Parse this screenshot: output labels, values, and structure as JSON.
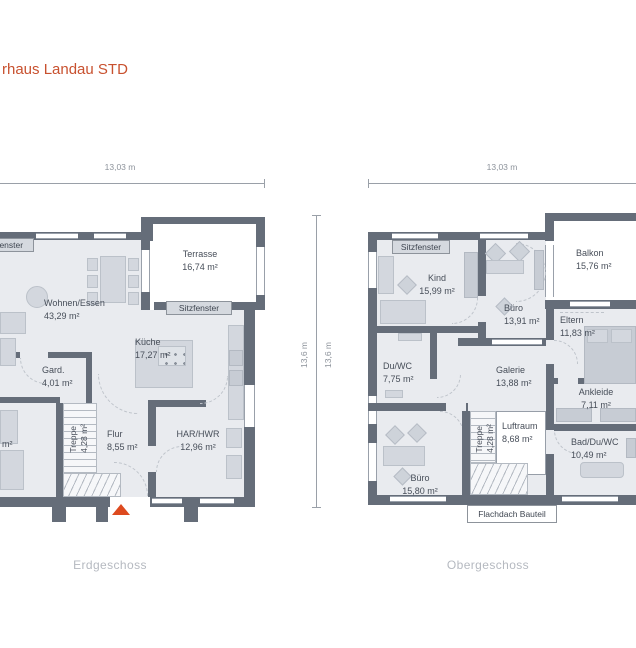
{
  "title": "rhaus Landau STD",
  "captions": {
    "left": "Erdgeschoss",
    "right": "Obergeschoss"
  },
  "dims": {
    "eg_w": "13,03 m",
    "eg_h": "13,6 m",
    "og_w": "13,03 m",
    "og_h": "13,6 m"
  },
  "eg": {
    "sitzfenster_left": "Sitzfenster",
    "sitzfenster_terrace": "Sitzfenster",
    "cut_label": "m²",
    "rooms": {
      "terrasse": {
        "label": "Terrasse",
        "area": "16,74 m²"
      },
      "wohnen": {
        "label": "Wohnen/Essen",
        "area": "43,29 m²"
      },
      "kueche": {
        "label": "Küche",
        "area": "17,27 m²"
      },
      "gard": {
        "label": "Gard.",
        "area": "4,01 m²"
      },
      "flur": {
        "label": "Flur",
        "area": "8,55 m²"
      },
      "har": {
        "label": "HAR/HWR",
        "area": "12,96 m²"
      },
      "treppe": {
        "label": "Treppe",
        "area": "4,28 m²"
      }
    }
  },
  "og": {
    "sitzfenster": "Sitzfenster",
    "flachdach": "Flachdach Bauteil",
    "rooms": {
      "balkon": {
        "label": "Balkon",
        "area": "15,76 m²"
      },
      "kind": {
        "label": "Kind",
        "area": "15,99 m²"
      },
      "buero1": {
        "label": "Büro",
        "area": "13,91 m²"
      },
      "eltern": {
        "label": "Eltern",
        "area": "11,83 m²"
      },
      "duwc": {
        "label": "Du/WC",
        "area": "7,75 m²"
      },
      "galerie": {
        "label": "Galerie",
        "area": "13,88 m²"
      },
      "ankleide": {
        "label": "Ankleide",
        "area": "7,11 m²"
      },
      "luftraum": {
        "label": "Luftraum",
        "area": "8,68 m²"
      },
      "bad": {
        "label": "Bad/Du/WC",
        "area": "10,49 m²"
      },
      "buero2": {
        "label": "Büro",
        "area": "15,80 m²"
      },
      "treppe": {
        "label": "Treppe",
        "area": "4,28 m²"
      }
    }
  },
  "colors": {
    "accent": "#c8512f",
    "wall": "#656d79",
    "floor": "#e9ebef",
    "entrance_marker": "#dd4a1f",
    "caption": "#b5b9c0"
  }
}
